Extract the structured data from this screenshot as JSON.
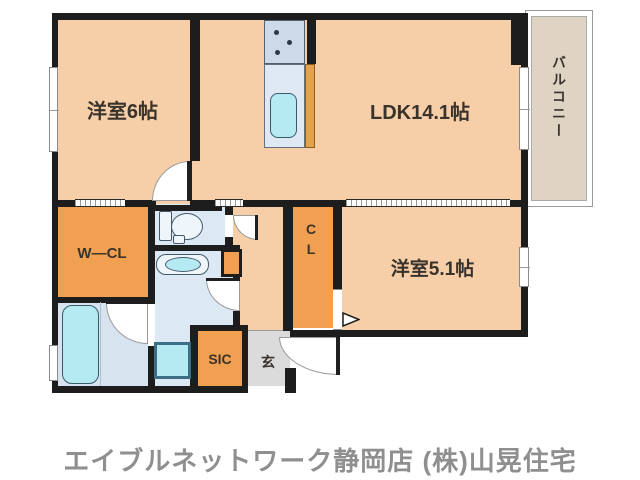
{
  "colors": {
    "wall": "#1d1d1d",
    "room-peach": "#f6cfa9",
    "closet-orange": "#f0a050",
    "kitchen-panel": "#e2a24e",
    "service-blue": "#dce8f3",
    "bath-blue": "#d7e4f0",
    "fixture-cyan": "#b5eaf3",
    "counter-blue": "#dfe9f4",
    "stove-blue": "#ccd9e8",
    "fixture-white": "#eef5fb",
    "balcony-tan": "#dfd4c4",
    "genkan-gray": "#dbdbdb",
    "label": "#3a332c",
    "caption-gray": "#8f8f8f"
  },
  "labels": {
    "bedroom1": "洋室6帖",
    "ldk": "LDK14.1帖",
    "bedroom2": "洋室5.1帖",
    "balcony": "バルコニー",
    "walk_in_closet": "W—CL",
    "closet": "CL",
    "shoe_closet": "SIC",
    "entrance": "玄"
  },
  "caption": "エイブルネットワーク静岡店 (株)山晃住宅"
}
